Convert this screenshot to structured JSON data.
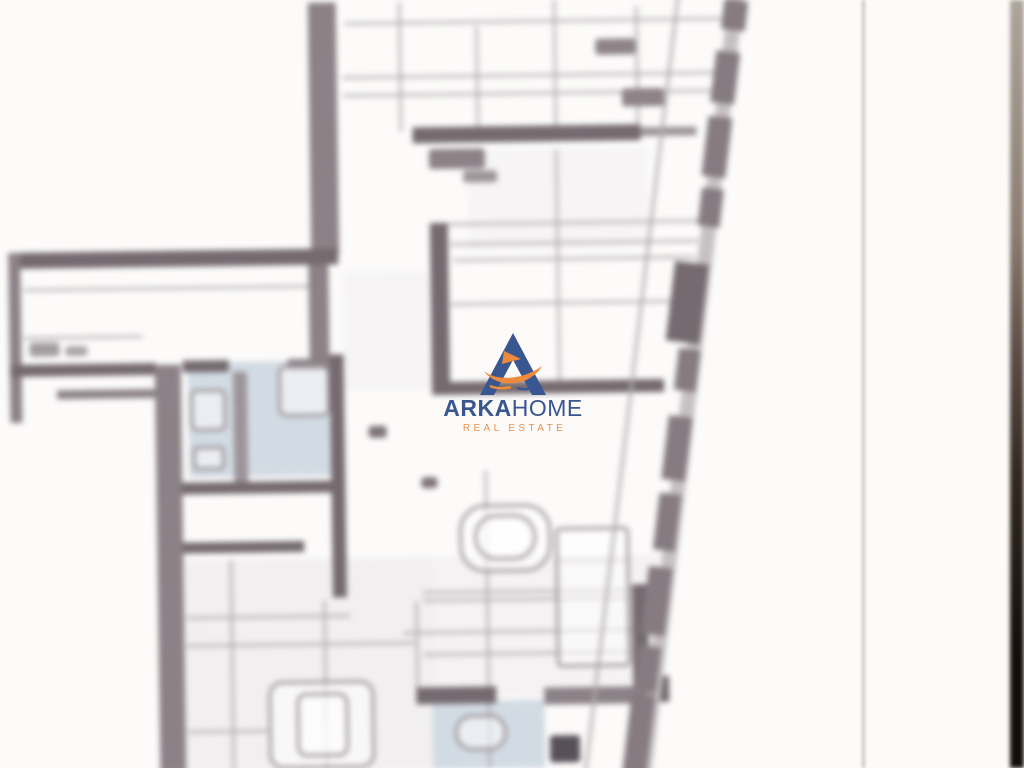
{
  "watermark": {
    "brand_bold": "ARKA",
    "brand_regular": "HOME",
    "tagline": "REAL ESTATE",
    "navy": "#3a5690",
    "orange": "#e8914d",
    "boat_orange": "#ee8a3c"
  },
  "page": {
    "background": "#fcfbfa",
    "fold_line_color": "#c9c4c5",
    "fold_line_x": 862,
    "edge_gradient": [
      "#ada49a",
      "#8b7e74",
      "#5f5148",
      "#32281f",
      "#140e0b"
    ]
  },
  "plan": {
    "blur_px": 3,
    "rotation_deg": -0.8,
    "colors": {
      "dark": "#746a6f",
      "mid": "#8b8186",
      "soft": "#9d9499",
      "line": "#b2acaf",
      "tint_blue": "#cdd7e0",
      "window_band": "#c6c0c3",
      "window_chunk": "#857b80"
    },
    "walls": [
      [
        313,
        0,
        28,
        252,
        "mid"
      ],
      [
        310,
        252,
        20,
        104,
        "mid"
      ],
      [
        10,
        246,
        330,
        16,
        "dark"
      ],
      [
        10,
        246,
        12,
        170,
        "mid"
      ],
      [
        10,
        358,
        146,
        12,
        "dark"
      ],
      [
        57,
        384,
        98,
        9,
        "mid"
      ],
      [
        183,
        356,
        46,
        12,
        "dark"
      ],
      [
        288,
        356,
        46,
        11,
        "mid"
      ],
      [
        155,
        360,
        26,
        408,
        "mid"
      ],
      [
        233,
        368,
        14,
        112,
        "soft"
      ],
      [
        330,
        352,
        14,
        243,
        "dark"
      ],
      [
        180,
        478,
        164,
        12,
        "dark"
      ],
      [
        180,
        538,
        122,
        11,
        "dark"
      ],
      [
        432,
        222,
        18,
        170,
        "dark"
      ],
      [
        432,
        381,
        232,
        13,
        "dark"
      ],
      [
        416,
        126,
        228,
        16,
        "dark"
      ],
      [
        644,
        129,
        56,
        9,
        "soft"
      ],
      [
        629,
        586,
        16,
        182,
        "dark"
      ],
      [
        629,
        678,
        36,
        26,
        "dark"
      ],
      [
        540,
        688,
        100,
        17,
        "mid"
      ],
      [
        412,
        686,
        80,
        17,
        "dark"
      ]
    ],
    "lines": [
      [
        350,
        20,
        390,
        "h"
      ],
      [
        347,
        74,
        392,
        "h"
      ],
      [
        347,
        92,
        390,
        "h"
      ],
      [
        403,
        0,
        130,
        "v"
      ],
      [
        480,
        26,
        104,
        "v"
      ],
      [
        558,
        0,
        132,
        "v"
      ],
      [
        640,
        8,
        122,
        "v"
      ],
      [
        558,
        150,
        232,
        "v"
      ],
      [
        450,
        222,
        252,
        "h"
      ],
      [
        452,
        242,
        248,
        "h"
      ],
      [
        455,
        258,
        242,
        "h"
      ],
      [
        452,
        302,
        238,
        "h"
      ],
      [
        25,
        282,
        288,
        "h"
      ],
      [
        25,
        330,
        118,
        "h"
      ],
      [
        183,
        612,
        164,
        "h"
      ],
      [
        183,
        640,
        228,
        "h"
      ],
      [
        420,
        590,
        208,
        "h"
      ],
      [
        420,
        598,
        206,
        "h"
      ],
      [
        400,
        630,
        230,
        "h"
      ],
      [
        420,
        652,
        208,
        "h"
      ],
      [
        227,
        556,
        212,
        "v"
      ],
      [
        320,
        598,
        170,
        "v"
      ],
      [
        412,
        600,
        86,
        "v"
      ],
      [
        483,
        470,
        298,
        "v"
      ],
      [
        183,
        726,
        80,
        "h"
      ],
      [
        556,
        560,
        68,
        "h"
      ]
    ],
    "washes": [
      [
        183,
        556,
        250,
        212,
        "#f1eff0"
      ],
      [
        430,
        556,
        228,
        140,
        "#f4f2f3"
      ],
      [
        345,
        270,
        86,
        118,
        "#f6f4f5"
      ],
      [
        470,
        150,
        180,
        100,
        "#f6f4f5"
      ]
    ],
    "tints": [
      [
        188,
        358,
        145,
        115
      ],
      [
        428,
        700,
        112,
        68
      ]
    ],
    "blobs": [
      [
        600,
        40,
        40,
        16,
        "#8d8388"
      ],
      [
        626,
        90,
        42,
        18,
        "#8d8388"
      ],
      [
        30,
        336,
        30,
        14,
        "#a39da0"
      ],
      [
        66,
        340,
        22,
        10,
        "#aaa4a7"
      ],
      [
        432,
        148,
        56,
        20,
        "#8b8186"
      ],
      [
        466,
        170,
        34,
        12,
        "#9d9499"
      ],
      [
        368,
        424,
        18,
        12,
        "#7d7378"
      ],
      [
        420,
        476,
        16,
        11,
        "#7d7378"
      ],
      [
        545,
        736,
        30,
        27,
        "#57505a"
      ]
    ],
    "outlines": [
      [
        278,
        362,
        52,
        52,
        8
      ],
      [
        190,
        385,
        36,
        42,
        6
      ],
      [
        192,
        442,
        32,
        24,
        4
      ],
      [
        553,
        528,
        74,
        140,
        5
      ],
      [
        457,
        504,
        92,
        68,
        26
      ],
      [
        472,
        514,
        62,
        46,
        22
      ],
      [
        264,
        678,
        106,
        88,
        14
      ],
      [
        292,
        690,
        52,
        64,
        10
      ],
      [
        450,
        714,
        52,
        36,
        17
      ]
    ],
    "edge": {
      "container": {
        "left": 661,
        "top": -16,
        "width": 60,
        "height": 800,
        "rotate_deg": 7.6
      },
      "band": {
        "x": 22,
        "w": 15
      },
      "inner_line": {
        "x": -30,
        "w": 3
      },
      "chunks": [
        [
          18,
          16,
          24,
          30
        ],
        [
          16,
          68,
          24,
          52
        ],
        [
          16,
          134,
          24,
          60
        ],
        [
          18,
          206,
          22,
          38
        ],
        [
          14,
          368,
          22,
          42
        ],
        [
          12,
          436,
          24,
          64
        ],
        [
          12,
          514,
          22,
          57
        ],
        [
          10,
          588,
          24,
          68
        ],
        [
          10,
          668,
          22,
          46
        ],
        [
          8,
          716,
          24,
          84
        ]
      ],
      "block": [
        0,
        282,
        34,
        80
      ]
    }
  }
}
